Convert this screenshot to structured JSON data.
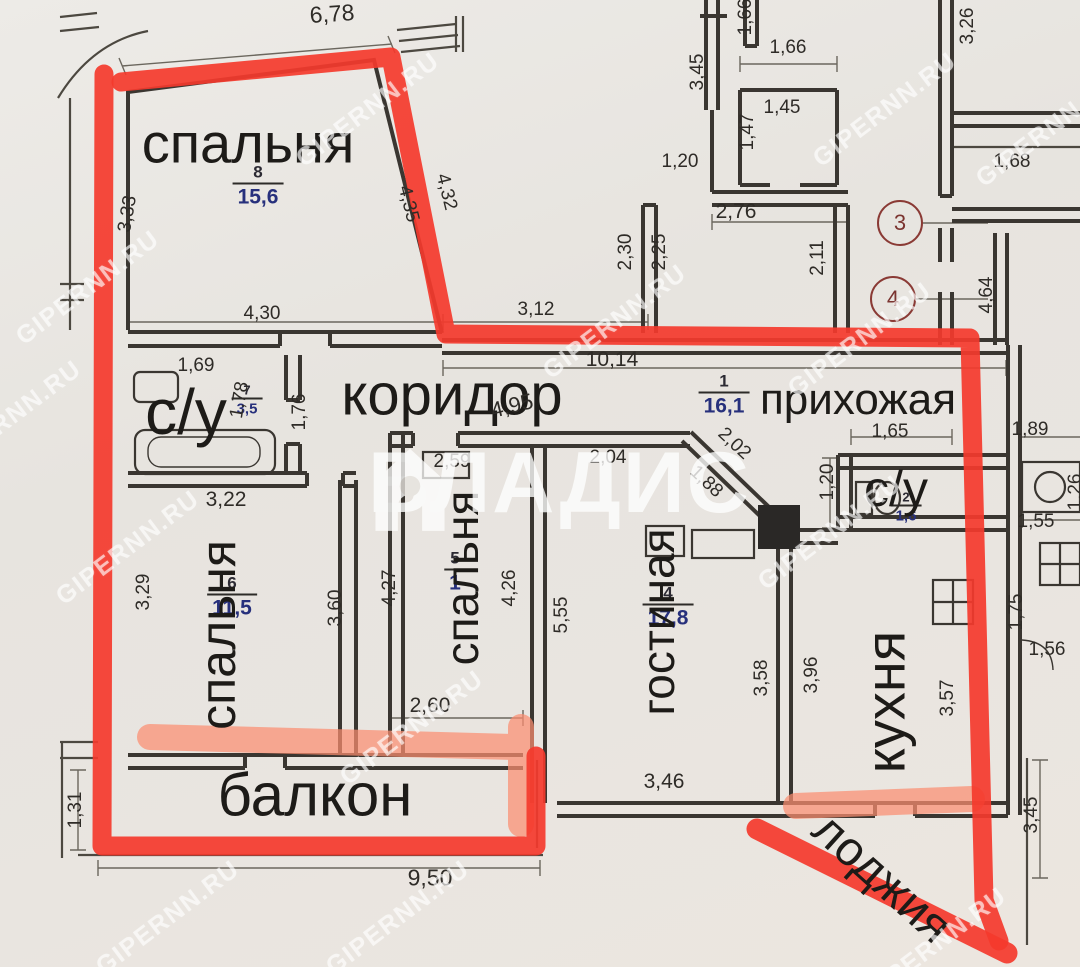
{
  "watermarks": {
    "site": "GIPERNN.RU",
    "brand": "ВЛАДИС"
  },
  "rooms": {
    "bedroom8": {
      "label": "спальня",
      "number": "8",
      "area": "15,6"
    },
    "bath7": {
      "label": "с/у",
      "number": "7",
      "area": "3,5"
    },
    "corridor": {
      "label": "коридор"
    },
    "hallway1": {
      "label": "прихожая",
      "number": "1",
      "area": "16,1"
    },
    "bedroom6": {
      "label": "спальня",
      "number": "6",
      "area": "11,5"
    },
    "bedroom5": {
      "label": "спальня",
      "number": "5",
      "area": "1"
    },
    "living4": {
      "label": "гостиная",
      "number": "4",
      "area": "17,8"
    },
    "bath2": {
      "label": "с/у",
      "number": "2",
      "area": "1,6"
    },
    "kitchen": {
      "label": "кухня"
    },
    "balcony": {
      "label": "балкон"
    },
    "loggia": {
      "label": "лоджия"
    }
  },
  "markers": {
    "m3": "3",
    "m4": "4"
  },
  "dims": {
    "d678": "6,78",
    "d166v": "1,66",
    "d326": "3,26",
    "d345t": "3,45",
    "d166h": "1,66",
    "d145": "1,45",
    "d147": "1,47",
    "d120t": "1,20",
    "d276": "2,76",
    "d168": "1,68",
    "d230": "2,30",
    "d225": "2,25",
    "d211": "2,11",
    "d464": "4,64",
    "d333": "3,33",
    "d435": "4,35",
    "d432": "4,32",
    "d430": "4,30",
    "d312": "3,12",
    "d1014": "10,14",
    "d169": "1,69",
    "d178": "1,78",
    "d176": "1,76",
    "d495": "4,95",
    "d165": "1,65",
    "d189": "1,89",
    "d202": "2,02",
    "d188": "1,88",
    "d204": "2,04",
    "d120r": "1,20",
    "d155": "1,55",
    "d126": "1,26",
    "d322": "3,22",
    "d259": "2,59",
    "d329": "3,29",
    "d360": "3,60",
    "d427": "4,27",
    "d426": "4,26",
    "d555": "5,55",
    "d358": "3,58",
    "d396": "3,96",
    "d346": "3,46",
    "d357": "3,57",
    "d175": "1,75",
    "d156": "1,56",
    "d260": "2,60",
    "d950": "9,50",
    "d131": "1,31",
    "d345b": "3,45"
  },
  "colors": {
    "red_outline": "#f4392c",
    "salmon_highlight": "#fb8e70",
    "area_ink": "#27307c"
  }
}
